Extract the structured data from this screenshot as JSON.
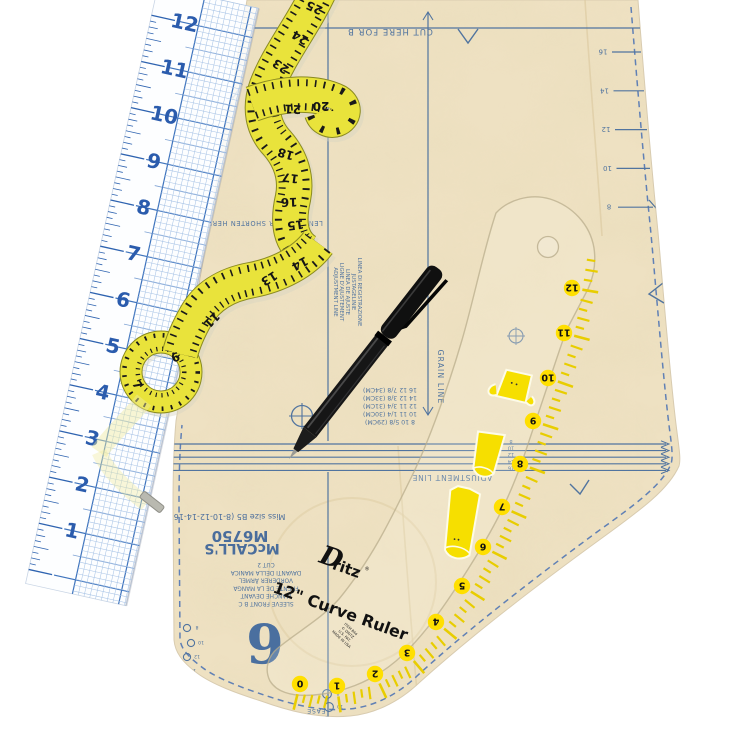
{
  "scene": {
    "description": "Sewing tools flat-lay: clear grid ruler, yellow tape measure, black pen, Dritz 12 inch curve ruler on a McCall's tissue pattern piece"
  },
  "colors": {
    "paper": "#eee1c2",
    "print_blue": "#51749f",
    "ruler_blue": "#2b5cad",
    "tape_yellow": "#e9e33b",
    "curve_yellow": "#ffdf00",
    "pen_black": "#141414"
  },
  "grid_ruler": {
    "numbers": [
      "12",
      "11",
      "10",
      "9",
      "8",
      "7",
      "6",
      "5",
      "4",
      "3",
      "2",
      "1"
    ]
  },
  "tape_measure": {
    "numbers": [
      "25",
      "24",
      "23",
      "21",
      "20",
      "18",
      "17",
      "16",
      "15",
      "14",
      "13",
      "11",
      "9",
      "7"
    ]
  },
  "curve_ruler": {
    "brand": "Dritz",
    "product": "12\" Curve Ruler",
    "numbers": [
      "0",
      "1",
      "2",
      "3",
      "4",
      "5",
      "6",
      "7",
      "8",
      "9",
      "10",
      "11",
      "12"
    ],
    "fine_print_lines": [
      "ITEM 844",
      "© DRITZ",
      "U.S. PAT.",
      "MADE IN USA"
    ]
  },
  "pattern": {
    "company": "McCALL'S",
    "pattern_number": "M6750",
    "size_line": "Miss size B5 (8-10-12-14-16)",
    "cut_here": "CUT HERE FOR B",
    "lengthen_shorten": "LENGTHEN OR SHORTEN HERE",
    "grain_line": "GRAIN LINE",
    "adjustment_line": "ADJUSTMENT LINE",
    "adjustment_lines_multilingual": [
      "ADJUSTMENT LINE",
      "LIGNE D'AJUSTEMENT",
      "LINEA DE AJUSTE",
      "JUSTAGELINIE",
      "LINEA DI REGISTRAZIONE"
    ],
    "piece_label_lines": [
      "CUT 2",
      "DAVANTI DELLA MANICA",
      "VORDERER ÄRMEL",
      "FRENTE DE LA MANGA",
      "MANCHE DEVANT",
      "SLEEVE FRONT  B C"
    ],
    "piece_number": "6",
    "ease": "EASE",
    "edge_size_numbers": [
      "16",
      "14",
      "12",
      "10",
      "8"
    ],
    "adjustment_size_numbers": [
      "8",
      "10",
      "12",
      "14",
      "16"
    ],
    "size_chart_rows": [
      "16 12 7/8 (34CM)",
      "14 12 3/8 (33CM)",
      "12 11 3/4 (31CM)",
      "10 11 1/4 (30CM)",
      "8 10 5/8 (29CM)"
    ],
    "dot_labels_left": [
      "8",
      "10",
      "12",
      "14"
    ],
    "dot_labels_center": [
      "8",
      "10",
      "12"
    ]
  }
}
